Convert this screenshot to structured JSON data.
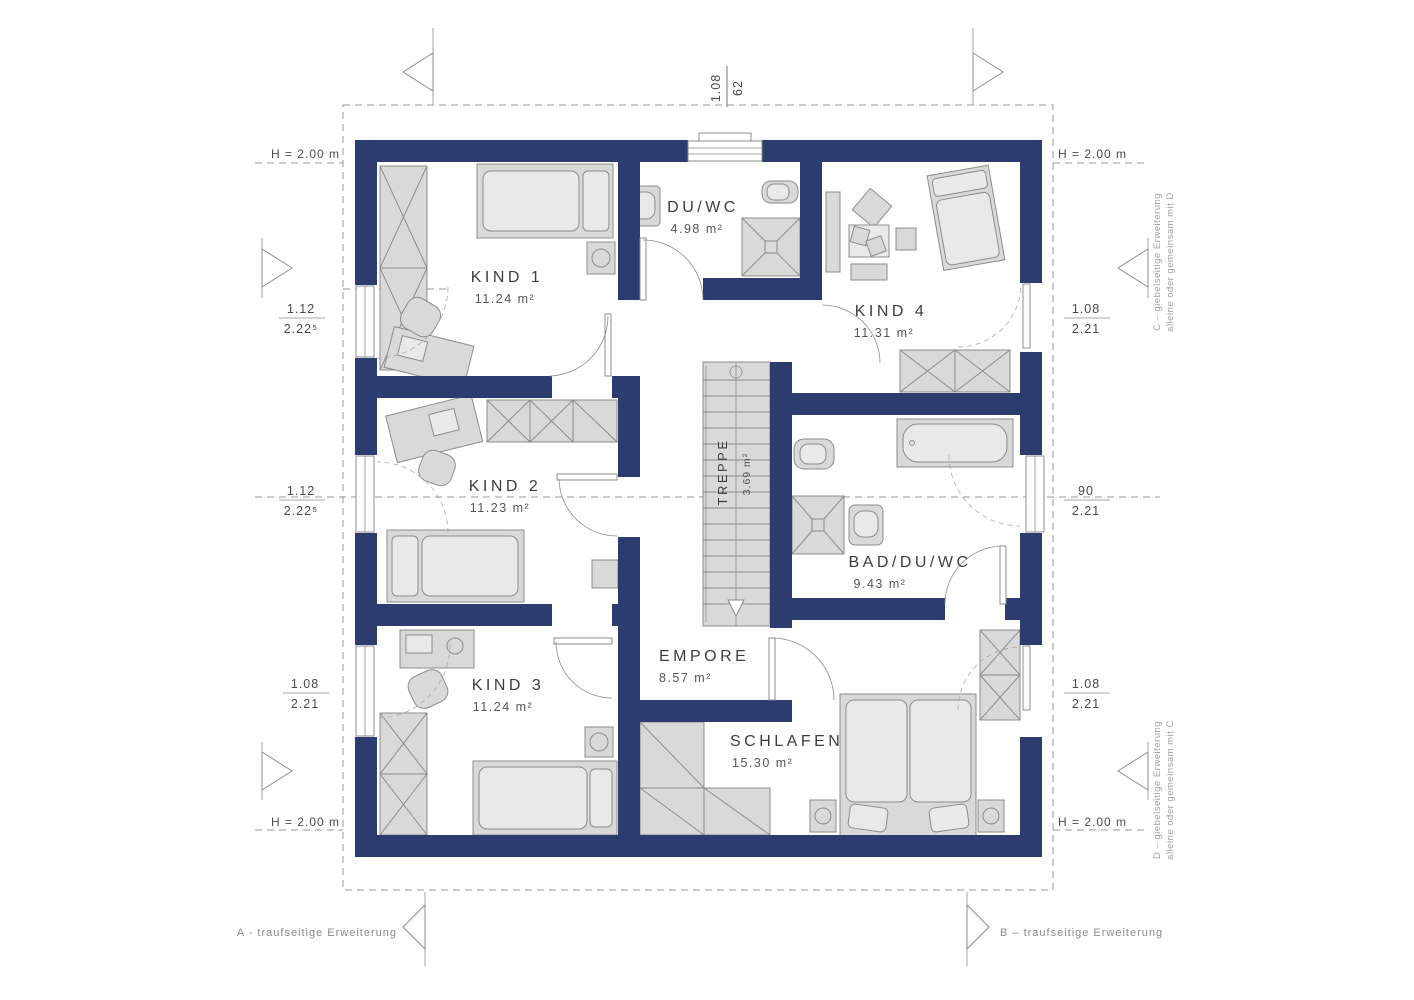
{
  "colors": {
    "wall": "#2c3c6e",
    "furniture_fill": "#d9d9d9",
    "furniture_stroke": "#8c8c8c",
    "construction_line": "#9a9a9a",
    "label_text": "#3d3d3d"
  },
  "rooms": [
    {
      "name": "KIND 1",
      "area": "11.24 m²"
    },
    {
      "name": "DU/WC",
      "area": "4.98 m²"
    },
    {
      "name": "KIND 4",
      "area": "11.31 m²"
    },
    {
      "name": "KIND 2",
      "area": "11.23 m²"
    },
    {
      "name": "TREPPE",
      "area": "3.69 m²"
    },
    {
      "name": "BAD/DU/WC",
      "area": "9.43 m²"
    },
    {
      "name": "KIND 3",
      "area": "11.24 m²"
    },
    {
      "name": "EMPORE",
      "area": "8.57 m²"
    },
    {
      "name": "SCHLAFEN",
      "area": "15.30 m²"
    }
  ],
  "dimensions": {
    "top": {
      "value1": "1.08",
      "value2": "62"
    },
    "left": [
      {
        "num": "1.12",
        "den": "2.22⁵"
      },
      {
        "num": "1.12",
        "den": "2.22⁵"
      },
      {
        "num": "1.08",
        "den": "2.21"
      }
    ],
    "right": [
      {
        "num": "1.08",
        "den": "2.21"
      },
      {
        "num": "90",
        "den": "2.21"
      },
      {
        "num": "1.08",
        "den": "2.21"
      }
    ],
    "height_top_left": "H = 2.00 m",
    "height_top_right": "H = 2.00 m",
    "height_bottom_left": "H = 2.00 m",
    "height_bottom_right": "H = 2.00 m"
  },
  "annotations": {
    "section_a": "A - traufseitige Erweiterung",
    "section_b": "B – traufseitige Erweiterung",
    "ext_c_line1": "C – giebelseitige Erweiterung",
    "ext_c_line2": "alleine oder gemeinsam mit D",
    "ext_d_line1": "D – giebelseitige Erweiterung",
    "ext_d_line2": "alleine oder gemeinsam mit C"
  }
}
